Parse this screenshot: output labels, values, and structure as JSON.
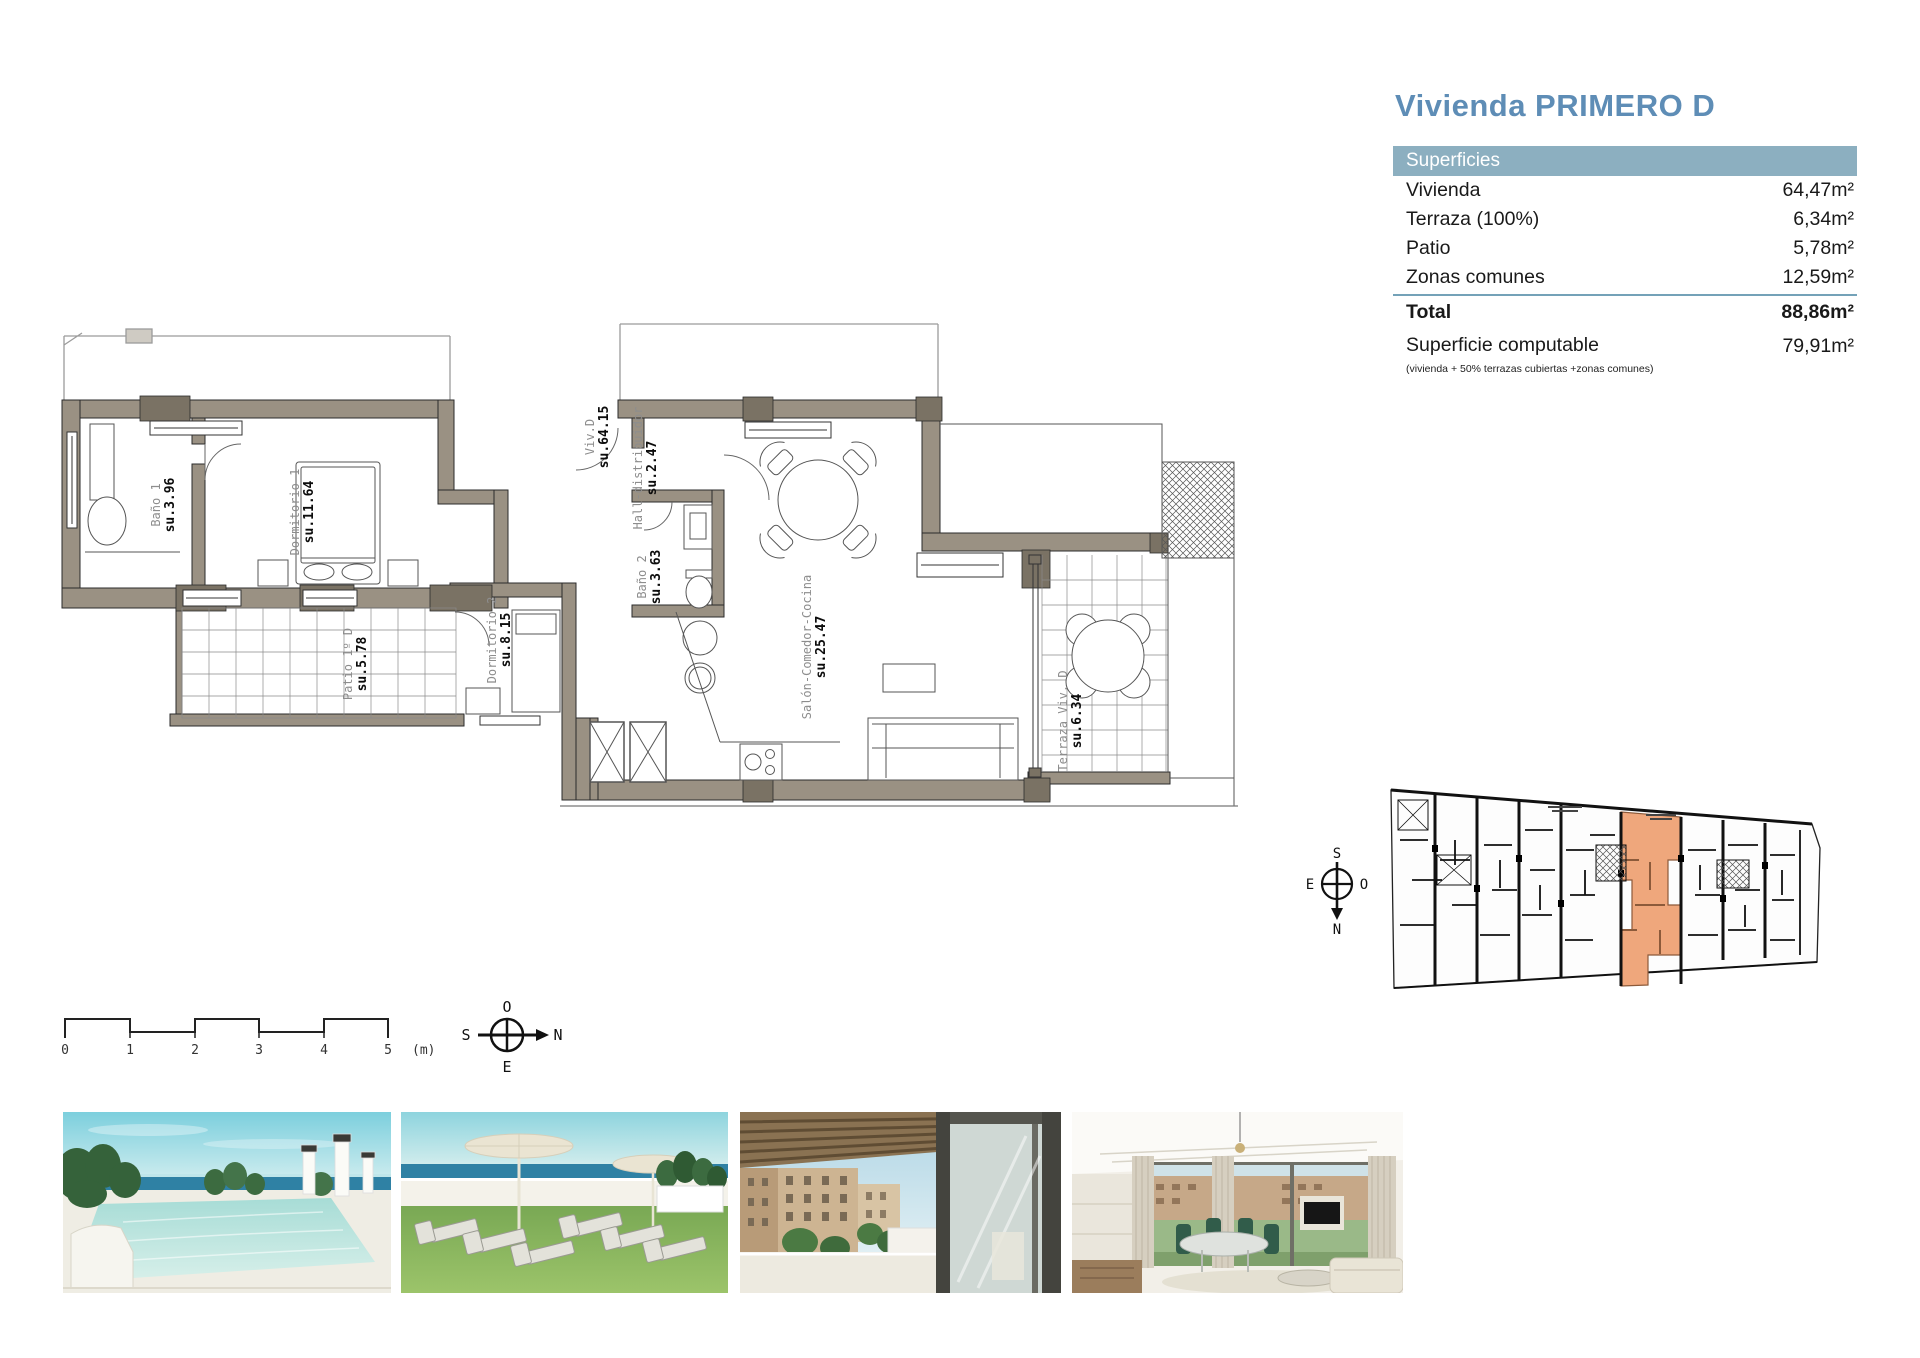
{
  "title": "Vivienda PRIMERO D",
  "surfaces": {
    "header": "Superficies",
    "rows": [
      {
        "label": "Vivienda",
        "value": "64,47m²"
      },
      {
        "label": "Terraza (100%)",
        "value": "6,34m²"
      },
      {
        "label": "Patio",
        "value": "5,78m²"
      },
      {
        "label": "Zonas comunes",
        "value": "12,59m²"
      }
    ],
    "total": {
      "label": "Total",
      "value": "88,86m²"
    },
    "computable": {
      "label": "Superficie computable",
      "note": "(vivienda + 50% terrazas cubiertas +zonas comunes)",
      "value": "79,91m²"
    }
  },
  "plan": {
    "rooms": [
      {
        "name": "Baño 1",
        "su": "su.3.96"
      },
      {
        "name": "Dormitorio 1",
        "su": "su.11.64"
      },
      {
        "name": "Patio 1º D",
        "su": "su.5.78"
      },
      {
        "name": "Dormitorio 2",
        "su": "su.8.15"
      },
      {
        "name": "Viv.D",
        "su": "su.64.15"
      },
      {
        "name": "Hall-distribuidor",
        "su": "su.2.47"
      },
      {
        "name": "Baño 2",
        "su": "su.3.63"
      },
      {
        "name": "Salón-Comedor-Cocina",
        "su": "su.25.47"
      },
      {
        "name": "Terraza Viv. D",
        "su": "su.6.34"
      }
    ]
  },
  "scalebar": {
    "ticks": [
      "0",
      "1",
      "2",
      "3",
      "4",
      "5"
    ],
    "unit": "(m)"
  },
  "compass_main": {
    "top": "O",
    "right": "N",
    "bottom": "E",
    "left": "S"
  },
  "compass_key": {
    "top": "S",
    "right": "O",
    "bottom": "N",
    "left": "E"
  },
  "colors": {
    "title_blue": "#5e8db6",
    "table_header": "#8cafc0",
    "wall_taupe": "#9a9183",
    "wall_dark": "#7a7264",
    "highlight_orange": "#efa77c"
  }
}
